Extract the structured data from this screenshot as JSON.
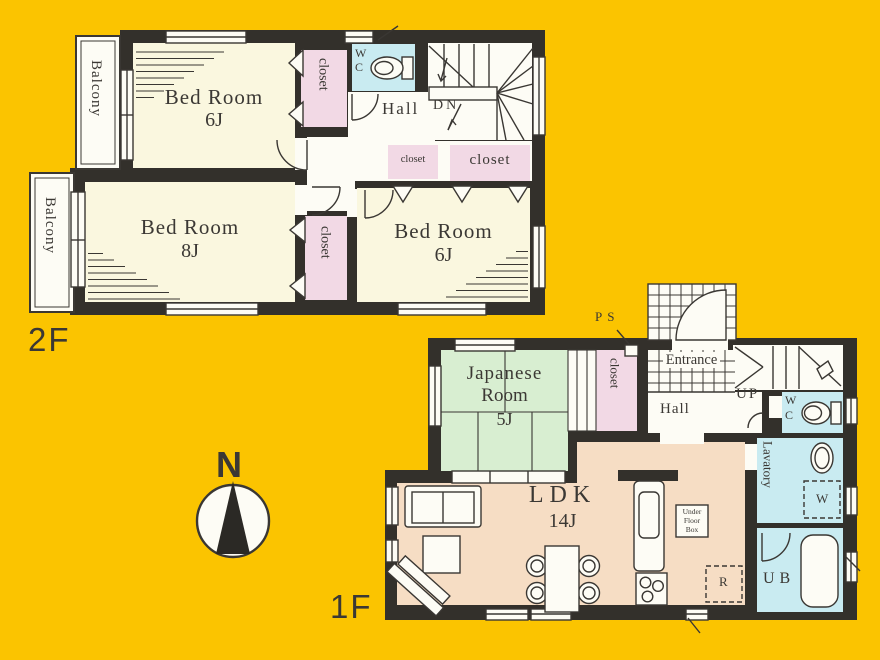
{
  "colors": {
    "background": "#FBC400",
    "wall": "#33302B",
    "room_cream": "#FAF7DF",
    "closet_pink": "#F2D9E5",
    "wet_area_blue": "#C9EBF1",
    "tatami_green": "#D8EED1",
    "ldk_peach": "#F6DDC4",
    "paper_white": "#FDFCF5",
    "line": "#3A3733"
  },
  "floor2": {
    "floor_label": "2F",
    "balcony_top": "Balcony",
    "balcony_bottom": "Balcony",
    "bedroom_a_name": "Bed Room",
    "bedroom_a_size": "6J",
    "bedroom_b_name": "Bed Room",
    "bedroom_b_size": "8J",
    "bedroom_c_name": "Bed Room",
    "bedroom_c_size": "6J",
    "closet_top": "closet",
    "closet_mid": "closet",
    "closet_hall_small": "closet",
    "closet_hall_large": "closet",
    "wc_line1": "W",
    "wc_line2": "C",
    "hall": "Hall",
    "down": "DN"
  },
  "floor1": {
    "floor_label": "1F",
    "pipe_space": "PS",
    "closet": "closet",
    "entrance": "Entrance",
    "hall": "Hall",
    "up": "UP",
    "wc_line1": "W",
    "wc_line2": "C",
    "lavatory": "Lavatory",
    "washer": "W",
    "unit_bath": "UB",
    "fridge": "R",
    "japanese_line1": "Japanese",
    "japanese_line2": "Room",
    "japanese_size": "5J",
    "ldk_name": "LDK",
    "ldk_size": "14J",
    "under_floor_1": "Under",
    "under_floor_2": "Floor",
    "under_floor_3": "Box"
  },
  "compass": {
    "north": "N"
  }
}
